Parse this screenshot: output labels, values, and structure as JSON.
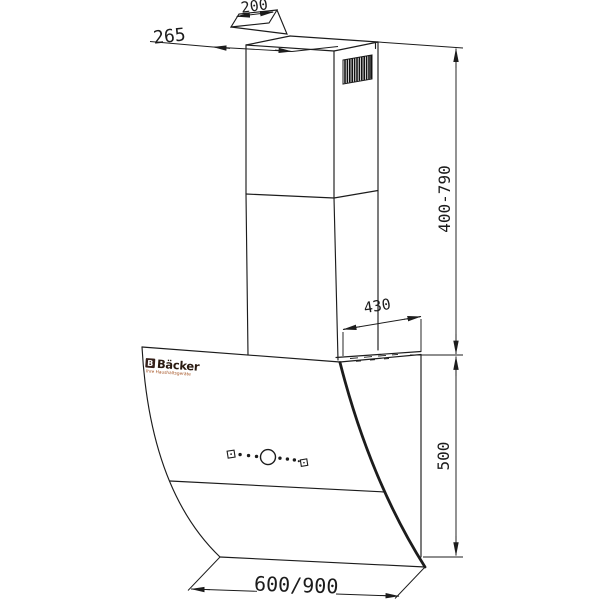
{
  "drawing": {
    "type": "technical-dimension-diagram",
    "subject": "wall-mounted inclined kitchen cooker hood with telescopic chimney",
    "brand": {
      "logo_letter": "B",
      "name": "Bäcker",
      "tagline": "Ihre Haushaltsgeräte"
    },
    "dimensions": {
      "duct_top_width": "200",
      "chimney_top_depth": "265",
      "chimney_height_range": "400-790",
      "body_top_depth": "430",
      "body_height": "500",
      "body_width_options": "600/900"
    },
    "colors": {
      "line": "#1c1c1c",
      "brand_text": "#2a1a10",
      "brand_tagline": "#a3501f",
      "logo_bg": "#35201a",
      "logo_letter": "#ffffff"
    }
  }
}
